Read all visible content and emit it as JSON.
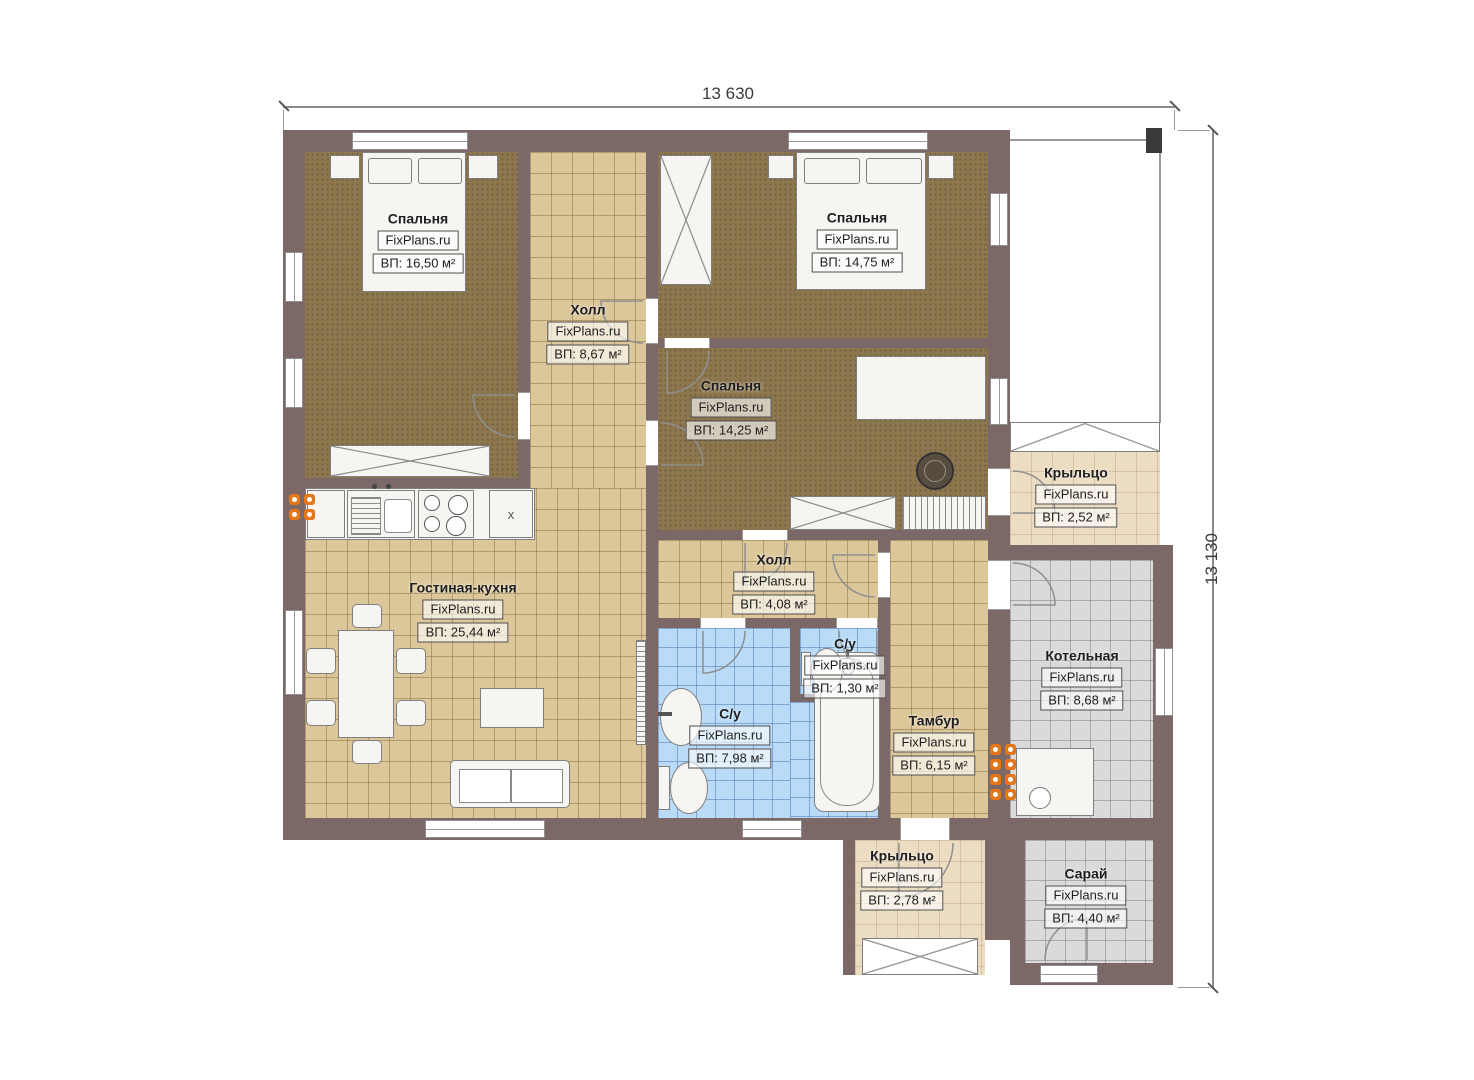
{
  "plan": {
    "title": "Floor plan",
    "dimensions": {
      "top": "13 630",
      "right": "13 130"
    },
    "rooms": [
      {
        "name": "Спальня",
        "watermark": "FixPlans.ru",
        "area": "ВП: 16,50 м²"
      },
      {
        "name": "Холл",
        "watermark": "FixPlans.ru",
        "area": "ВП: 8,67 м²"
      },
      {
        "name": "Спальня",
        "watermark": "FixPlans.ru",
        "area": "ВП: 14,75 м²"
      },
      {
        "name": "Спальня",
        "watermark": "FixPlans.ru",
        "area": "ВП: 14,25 м²"
      },
      {
        "name": "Крыльцо",
        "watermark": "FixPlans.ru",
        "area": "ВП: 2,52 м²"
      },
      {
        "name": "Гостиная-кухня",
        "watermark": "FixPlans.ru",
        "area": "ВП: 25,44 м²"
      },
      {
        "name": "Холл",
        "watermark": "FixPlans.ru",
        "area": "ВП: 4,08 м²"
      },
      {
        "name": "С/у",
        "watermark": "FixPlans.ru",
        "area": "ВП: 1,30 м²"
      },
      {
        "name": "С/у",
        "watermark": "FixPlans.ru",
        "area": "ВП: 7,98 м²"
      },
      {
        "name": "Тамбур",
        "watermark": "FixPlans.ru",
        "area": "ВП: 6,15 м²"
      },
      {
        "name": "Котельная",
        "watermark": "FixPlans.ru",
        "area": "ВП: 8,68 м²"
      },
      {
        "name": "Крыльцо",
        "watermark": "FixPlans.ru",
        "area": "ВП: 2,78 м²"
      },
      {
        "name": "Сарай",
        "watermark": "FixPlans.ru",
        "area": "ВП: 4,40 м²"
      }
    ],
    "kitchen": {
      "cabinet_mark": "x"
    },
    "colors": {
      "wall": "#7b6867",
      "carpet": "#8d774e",
      "tile_tan": "#dcc79a",
      "tile_blue": "#b9dbf8",
      "tile_gray": "#dadada",
      "porch": "#ecdcc2",
      "radiator": "#e4761b"
    }
  }
}
